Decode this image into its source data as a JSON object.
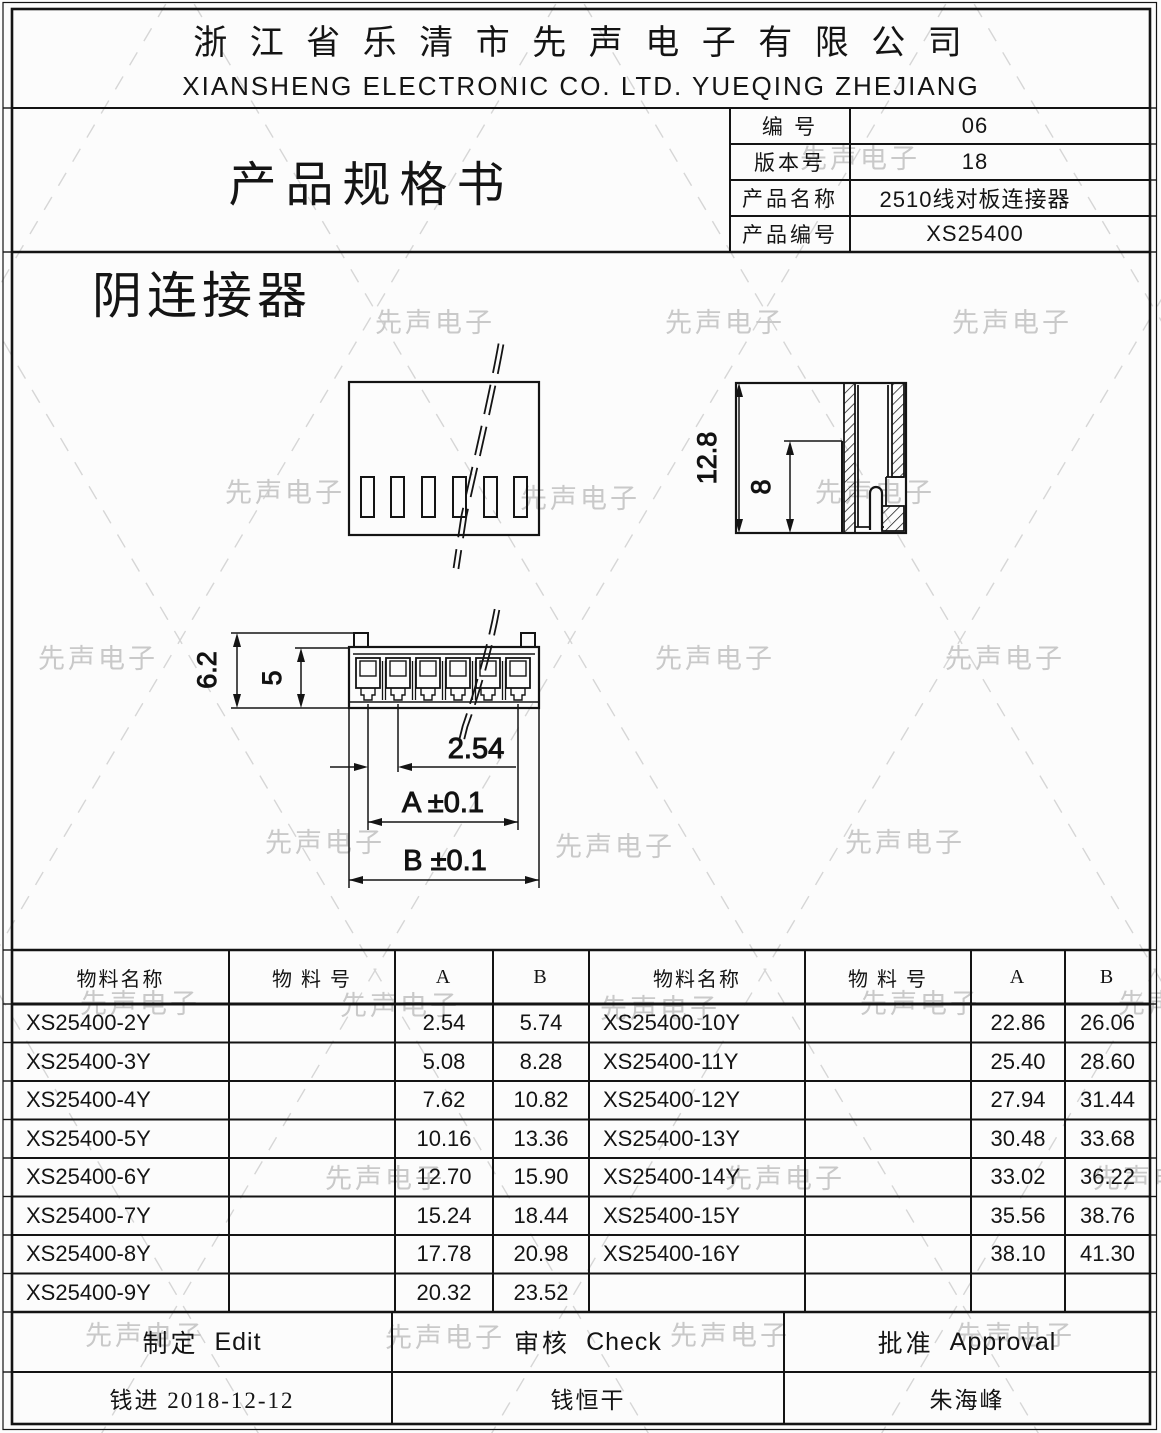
{
  "header": {
    "company_cn": "浙 江 省 乐 清 市 先 声 电 子 有 限 公 司",
    "company_en": "XIANSHENG ELECTRONIC CO. LTD. YUEQING ZHEJIANG"
  },
  "doc": {
    "title": "产品规格书",
    "fields": [
      {
        "label": "编 号",
        "value": "06"
      },
      {
        "label": "版本号",
        "value": "18"
      },
      {
        "label": "产品名称",
        "value": "2510线对板连接器"
      },
      {
        "label": "产品编号",
        "value": "XS25400"
      }
    ]
  },
  "drawing": {
    "title": "阴连接器",
    "dims": {
      "total_height": "12.8",
      "inner_height": "8",
      "total_depth": "6.2",
      "inner_depth": "5",
      "pitch": "2.54",
      "dim_a": "A ±0.1",
      "dim_b": "B ±0.1"
    }
  },
  "parts_table": {
    "headers": [
      "物料名称",
      "物 料 号",
      "A",
      "B",
      "物料名称",
      "物 料 号",
      "A",
      "B"
    ],
    "rows": [
      [
        "XS25400-2Y",
        "",
        "2.54",
        "5.74",
        "XS25400-10Y",
        "",
        "22.86",
        "26.06"
      ],
      [
        "XS25400-3Y",
        "",
        "5.08",
        "8.28",
        "XS25400-11Y",
        "",
        "25.40",
        "28.60"
      ],
      [
        "XS25400-4Y",
        "",
        "7.62",
        "10.82",
        "XS25400-12Y",
        "",
        "27.94",
        "31.44"
      ],
      [
        "XS25400-5Y",
        "",
        "10.16",
        "13.36",
        "XS25400-13Y",
        "",
        "30.48",
        "33.68"
      ],
      [
        "XS25400-6Y",
        "",
        "12.70",
        "15.90",
        "XS25400-14Y",
        "",
        "33.02",
        "36.22"
      ],
      [
        "XS25400-7Y",
        "",
        "15.24",
        "18.44",
        "XS25400-15Y",
        "",
        "35.56",
        "38.76"
      ],
      [
        "XS25400-8Y",
        "",
        "17.78",
        "20.98",
        "XS25400-16Y",
        "",
        "38.10",
        "41.30"
      ],
      [
        "XS25400-9Y",
        "",
        "20.32",
        "23.52",
        "",
        "",
        "",
        ""
      ]
    ]
  },
  "signoff": {
    "columns": [
      {
        "cn": "制定",
        "en": "Edit"
      },
      {
        "cn": "审核",
        "en": "Check"
      },
      {
        "cn": "批准",
        "en": "Approval"
      }
    ],
    "values": [
      "钱进  2018-12-12",
      "钱恒干",
      "朱海峰"
    ]
  },
  "watermark": {
    "text": "先声电子"
  }
}
